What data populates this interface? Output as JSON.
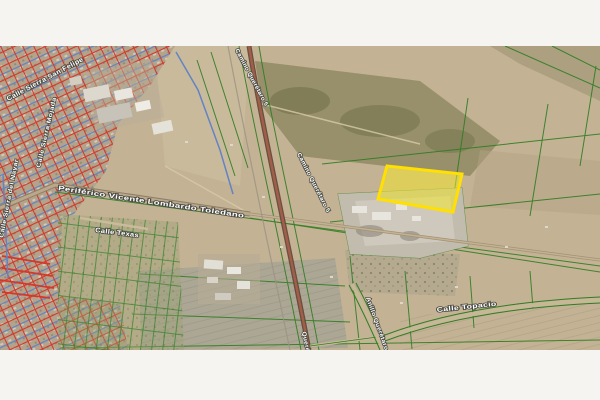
{
  "page": {
    "background_color": "#f5f4f0",
    "content_kind": "aerial satellite map with cadastral overlay"
  },
  "map": {
    "description": "Satellite photo of city outskirts with street grid overlay (blue/red), green parcel boundaries and one highlighted yellow land parcel",
    "highlighted_parcel": {
      "fill_color": "#f0e42d",
      "border_color": "#ffe000"
    },
    "road_labels": {
      "sierra_san_felipe": "Calle Sierra San Felipe",
      "sierra_mojada": "Calle Sierra Mojada",
      "sierra_del_nayar": "Calle Sierra del Nayar",
      "periferico": "Periférico Vicente Lombardo Toledano",
      "calle_texas": "Calle Texas",
      "camino_queretaro_top": "Camino Querétaro 5",
      "camino_queretaro_mid": "Camino Querétaro 5",
      "camino_queretaro_bottom": "Querétaro 5",
      "anillo_queretaro": "Anillo Querétaro",
      "calle_topacio": "Calle Topacio"
    },
    "overlay_colors": {
      "street_grid_blue": "#6284c4",
      "street_grid_red": "#d5372a",
      "parcel_boundary_green": "#2f7d22",
      "terrain_tan": "#c4b294"
    }
  }
}
